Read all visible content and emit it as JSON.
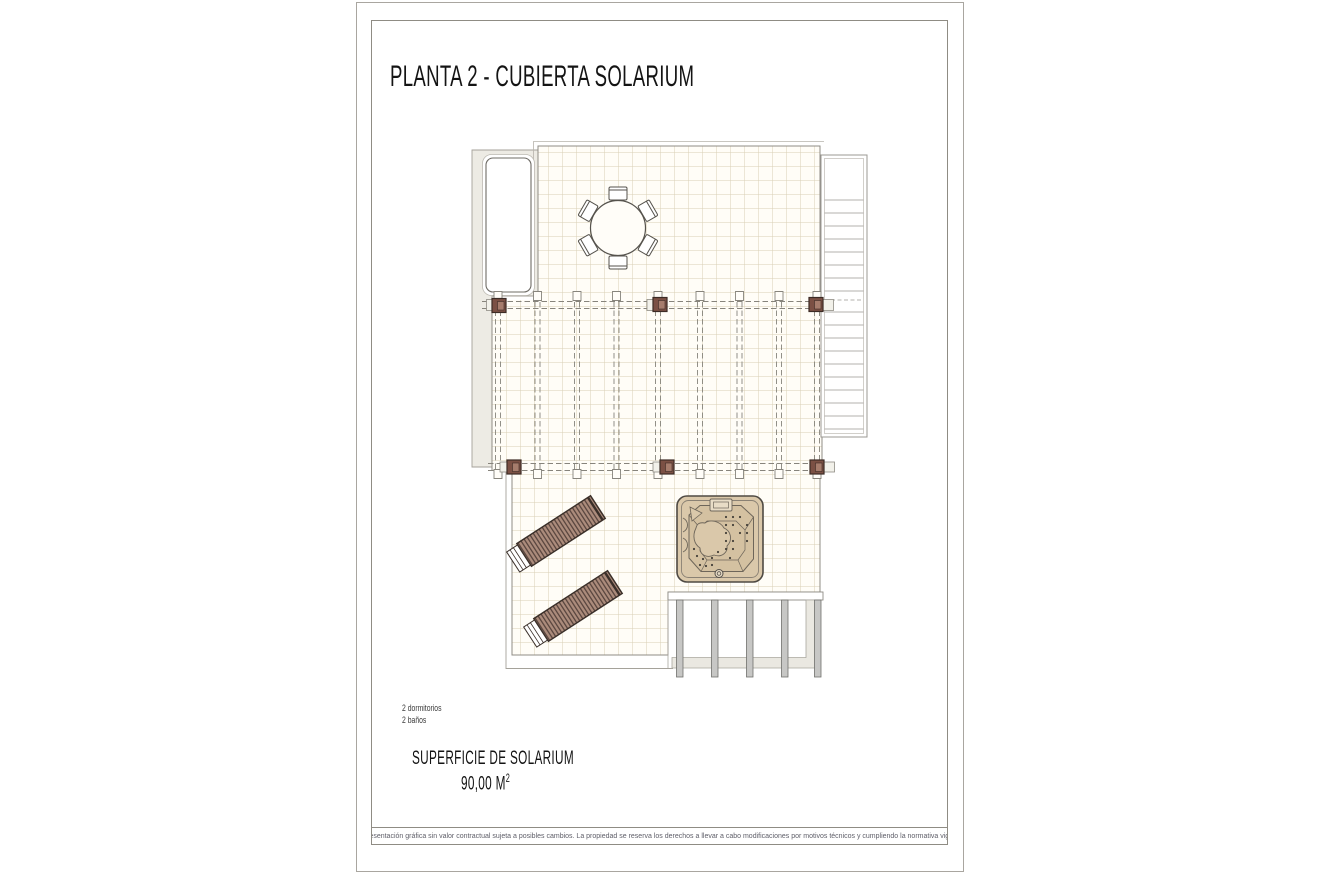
{
  "page": {
    "title": "PLANTA 2 - CUBIERTA SOLARIUM",
    "features": [
      "2 dormitorios",
      "2 baños"
    ],
    "surface": {
      "label": "SUPERFICIE DE SOLARIUM",
      "value_main": "90,00 M",
      "value_sup": "2"
    },
    "disclaimer": "Representación gráfica sin valor contractual sujeta a posibles cambios. La propiedad se reserva los derechos a llevar a cabo modificaciones por motivos técnicos y cumpliendo la normativa vigente."
  },
  "plan": {
    "elements": [
      "skylight",
      "dining-table-6-chairs",
      "pergola-beams",
      "pergola-columns",
      "staircase",
      "jacuzzi",
      "sun-loungers",
      "lower-terrace-posts"
    ],
    "colors": {
      "tile_line": "#d9d0b6",
      "column": "#7b5044",
      "lounger_stripe": "#ab8b7b",
      "jacuzzi_fill": "#dac8aa",
      "outline": "#8f8c84",
      "area_fill": "#edebe4"
    }
  }
}
